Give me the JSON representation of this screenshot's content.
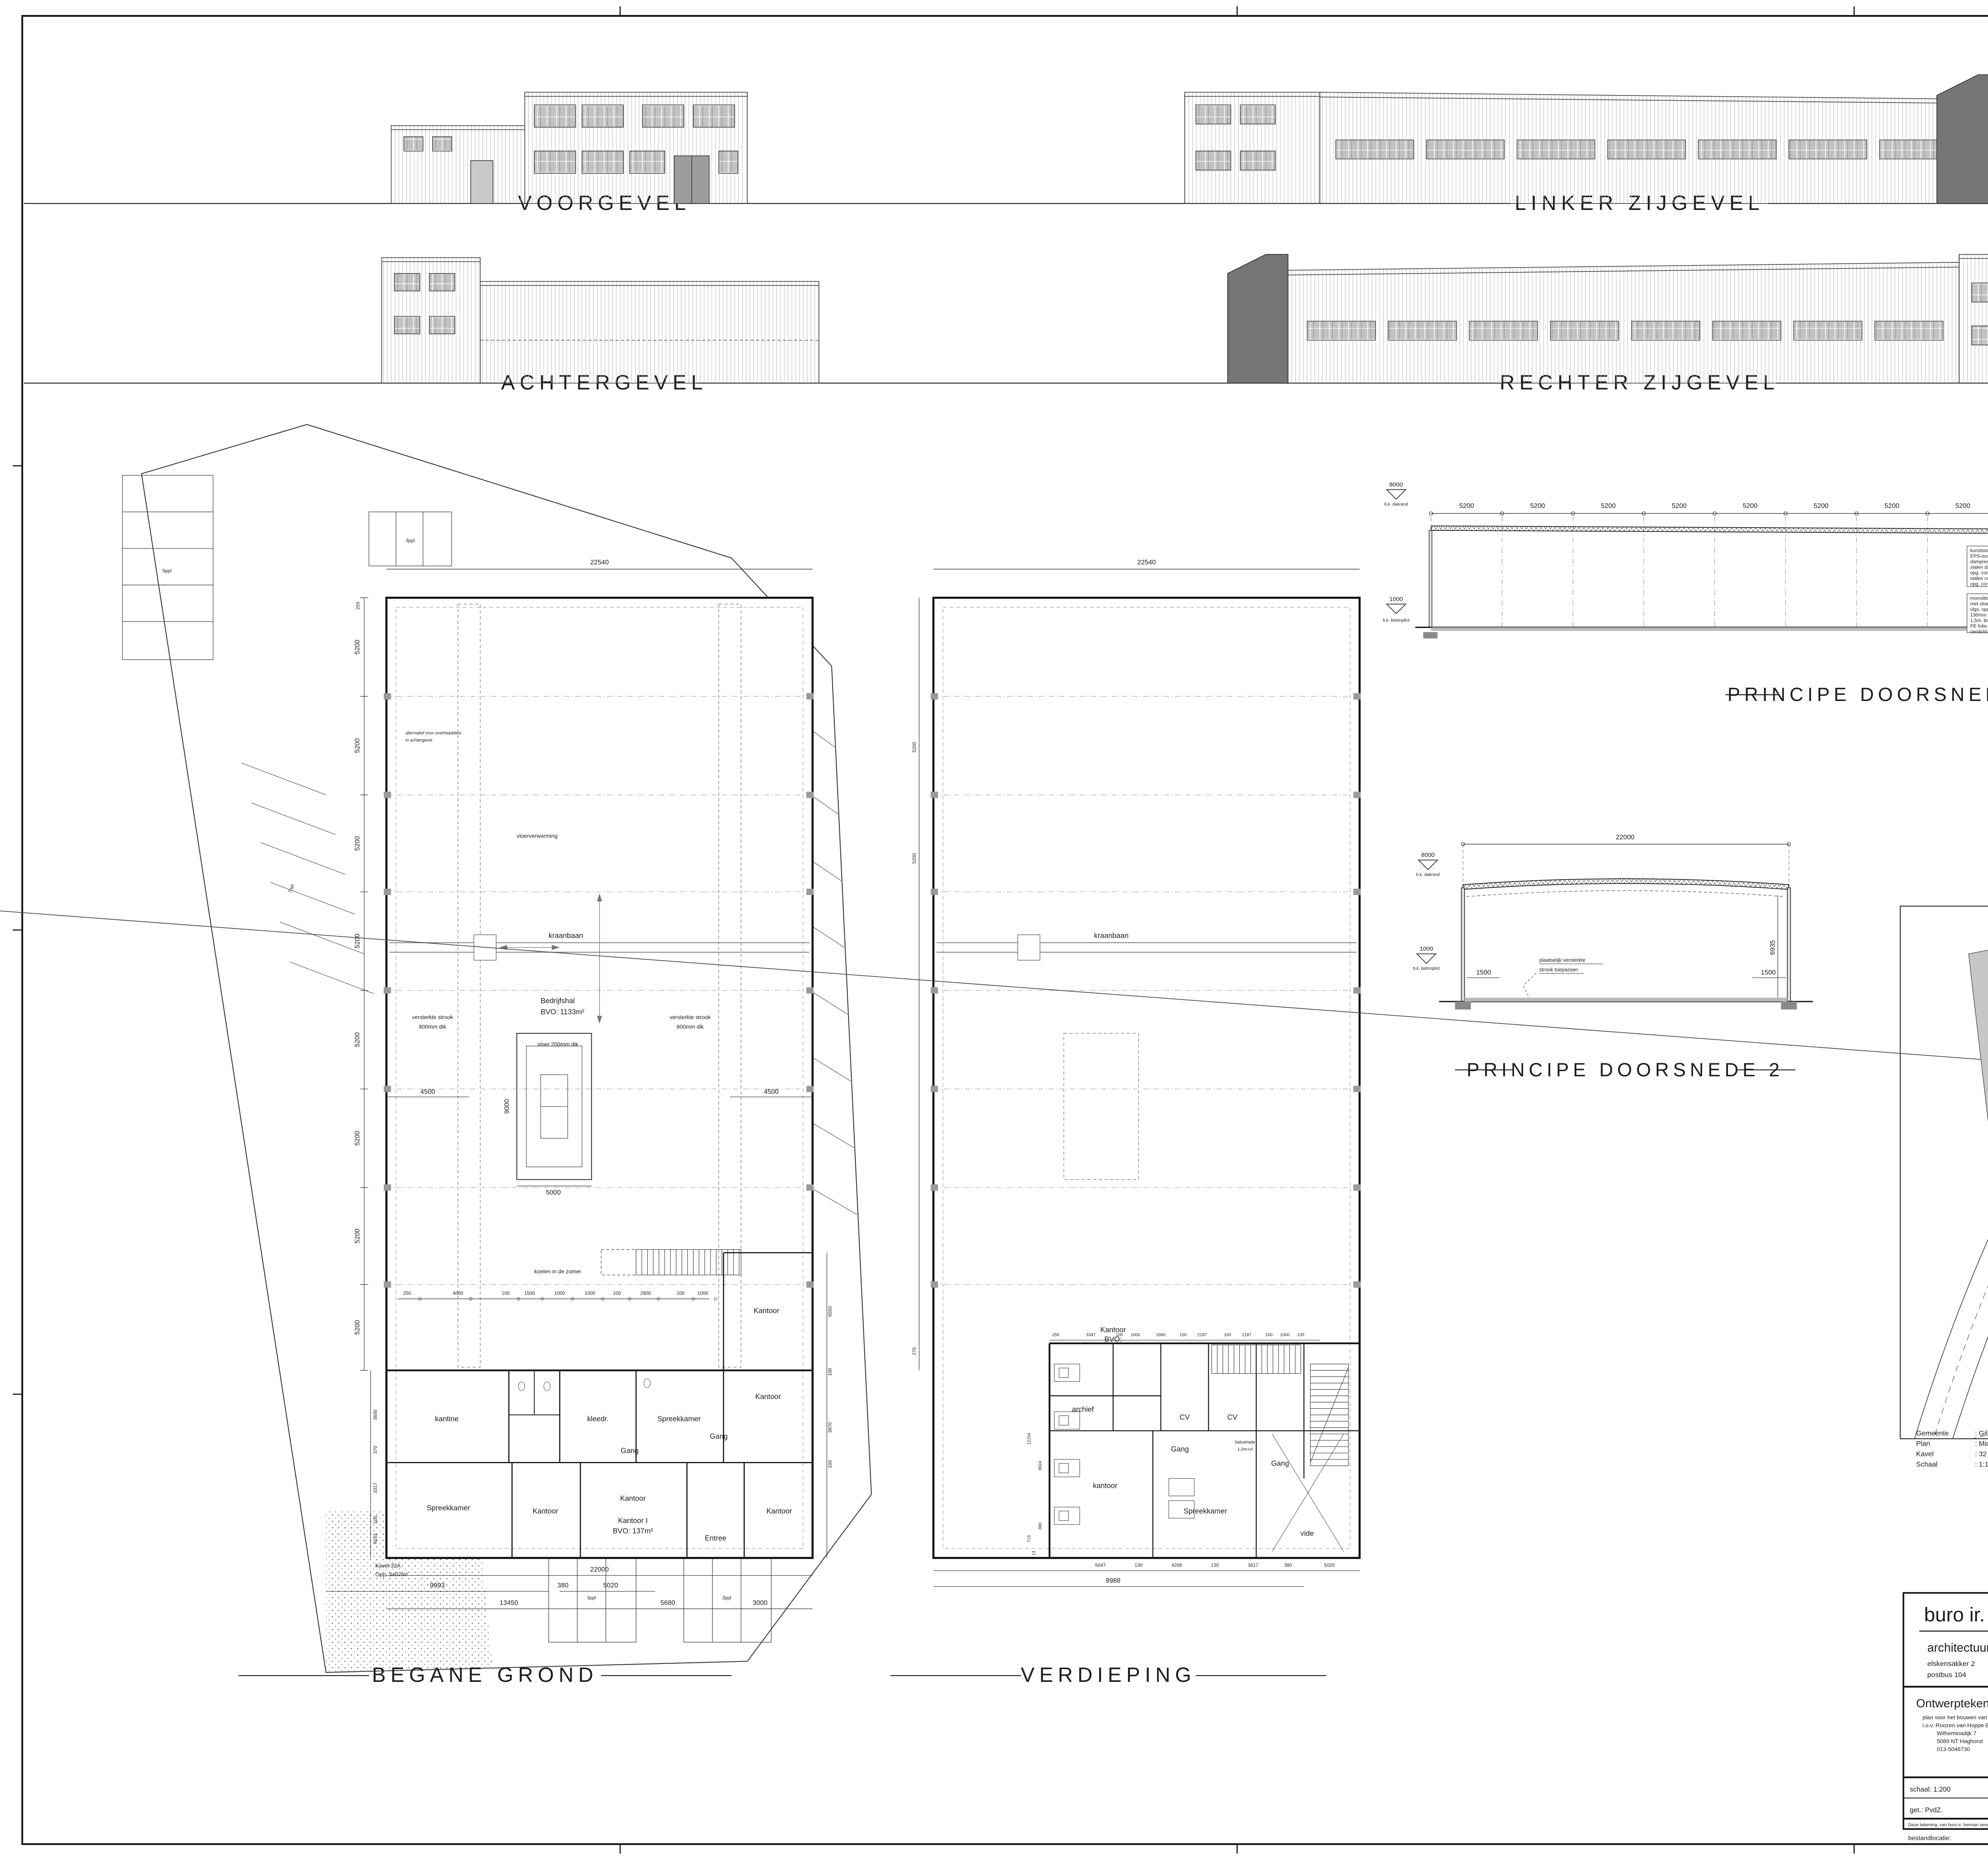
{
  "colors": {
    "accent_green": "#567d1f",
    "dark_volume": "#757575",
    "glazing": "#c2c2c2"
  },
  "sheet_labels": {
    "front": "VOORGEVEL",
    "left_side": "LINKER ZIJGEVEL",
    "rear": "ACHTERGEVEL",
    "right_side": "RECHTER ZIJGEVEL",
    "section1": "PRINCIPE DOORSNEDE 1",
    "section2": "PRINCIPE DOORSNEDE 2",
    "ground_floor": "BEGANE GROND",
    "first_floor": "VERDIEPING"
  },
  "project": {
    "gemeente_label": "Gemeente",
    "gemeente": ": Gilze-Rijen",
    "plan_label": "Plan",
    "plan": ": Midden Brabant Poort",
    "kavel_label": "Kavel",
    "kavel": ": 32",
    "schaal_label": "Schaal",
    "schaal": ": 1:1000"
  },
  "dims": {
    "d5200": "5200",
    "d22540": "22540",
    "d7720": "7720",
    "d380": "380",
    "d8000": "8000",
    "d3800": "3800",
    "d1000": "1000",
    "d1500": "1500",
    "d22000": "22000",
    "d6935": "6935",
    "d4500": "4500",
    "d9000": "9000",
    "d5000": "5000",
    "zero": "±0.00",
    "d270": "270"
  },
  "levels": {
    "dakrand": "b.k. dakrand",
    "vloer": "b.k. vloer",
    "betonplint": "b.k. betonplint"
  },
  "section1_specs": {
    "roof": [
      "kunststof dakbedekking",
      "EPS-isolatie Rc > 6.0",
      "dampremmende folie",
      "stalen dakplaat vlgs.",
      "opg. constructeur",
      "stalen constructie vlgs.",
      "opg. constructeur"
    ],
    "ground": [
      "monolitisch afgewerkte betonvloer",
      "met vloerverwarming",
      "vlgs. opg. constructeur",
      "130mm EPS-100 isolatie",
      "1,5m. breed langs zijkanten vloer",
      "PE folie",
      "verdicht zandpakket"
    ],
    "floor1": [
      "monolitische afwerkvloer 70mm",
      "met vloerverwarming",
      "kanaalplaatvloer",
      "vlgs. opg. constructeur",
      "stalenconstructie vlgs. opg. constr.",
      "systeemplafond"
    ],
    "ground2": [
      "monolitisch afgewerkte betonvloer",
      "met vloerverwarming",
      "vlgs. opg. constructeur",
      "isolatie Rc > 3,5",
      "PE folie",
      "verdicht zandpakket"
    ]
  },
  "section2": {
    "note1": "plaatselijk versterkte",
    "note2": "strook toepassen"
  },
  "ground_plan": {
    "annotations": {
      "koelen": "koelen in de zomer",
      "kraanbaan": "kraanbaan",
      "vloerverwarming": "vloerverwarming",
      "bedrijfshal": "Bedrijfshal",
      "bvo": "BVO: 1133m²",
      "vloer": "vloer 200mm dik",
      "strook1": "versterkte strook",
      "strook2": "800mm dik",
      "alt1": "alternatief voor overheaddeur",
      "alt2": "in achtergevel",
      "kavel1": "Kavel 32A",
      "kavel2": "Opp: 3407m²"
    },
    "rooms": {
      "kantine": "kantine",
      "kleedr": "kleedr.",
      "spreekkamer": "Spreekkamer",
      "gang": "Gang",
      "kantoor": "Kantoor",
      "kantoor1": "Kantoor I",
      "kantoor1_bvo": "BVO: 137m²",
      "entree": "Entree"
    },
    "dimrow": [
      "250",
      "4000",
      "100",
      "1500",
      "1000",
      "1000",
      "100",
      "2900",
      "100",
      "1000"
    ],
    "left_chain": [
      "3600",
      "370",
      "3317",
      "100",
      "4033"
    ],
    "right_chain": [
      "6550",
      "100",
      "3870",
      "100"
    ],
    "bottom": [
      "22000",
      "9993",
      "380",
      "5020",
      "13450",
      "5680",
      "3000"
    ]
  },
  "first_floor_plan": {
    "rooms": {
      "archief": "archief",
      "cv": "CV",
      "gang": "Gang",
      "balustrade1": "balustrade",
      "balustrade2": "1,0m+vl",
      "kantoor": "kantoor",
      "kantoor_bvo1": "Kantoor",
      "kantoor_bvo2": "BVO:",
      "spreekkamer": "Spreekkamer",
      "vide": "vide"
    },
    "dimrow": [
      "250",
      "3347",
      "100",
      "1000",
      "1680",
      "100",
      "2187",
      "100",
      "2187",
      "100",
      "1000",
      "135"
    ],
    "left_chain": [
      "12154",
      "9924",
      "713",
      "380",
      "13"
    ],
    "side_chain": [
      "5200",
      "5200",
      "270"
    ],
    "bottom": [
      "5047",
      "130",
      "4206",
      "130",
      "3617",
      "380",
      "5020",
      "9988"
    ]
  },
  "parking": {
    "p3": "3ppl",
    "p5": "5ppl",
    "p7": "7ppl"
  },
  "site": {
    "north": "N"
  },
  "title_block": {
    "firm": "buro ir. herman sengers",
    "tagline_black": "architectuur | design |",
    "tagline_green": "realisatie",
    "address1": "elskensakker 2",
    "address1b": "5571 sk bergeijk",
    "address2": "postbus 104",
    "address2b": "5570 ac bergeijk",
    "tel": "tel: 0497 573204   fax: 0497-574300",
    "email": "e-mail: info@burosengers.nl",
    "doc_type": "Ontwerptekening",
    "desc1": "plan voor het bouwen van een bedrijfshal   te Gilze tbv. MK Gilze",
    "desc2": "i.o.v. Roozen van Hoppe Bauw & Ontwikkeling",
    "desc3": "Wilheminadijk 7",
    "desc4": "5089 NT Haghorst",
    "desc5": "013-5046730",
    "werknr_label": "werknr.",
    "werknr": "16-2293",
    "bladnr_label": "bladnr.",
    "bladnr": "010.",
    "schaal": "schaal: 1:200",
    "dd": "d.d.:   30.09.2016",
    "gewB": "gew.B:  24-09-2018",
    "gewD": "gew.D:  26.10.2018",
    "gewF": "gew.F:",
    "get": "get.:   PvdZ.",
    "gewA": "gew.A:  03.10.2016",
    "gewC": "gew.C:  27-09-2018",
    "gewE": "gew.E:  30.11.2018",
    "ig": "i.g.    :",
    "formaat": "formaat:  A1",
    "disclaimer": "Deze tekening, van buro ir. herman sengers, mag alleen met onze toestemming geheel of gedeeltelijk gebruikt, gekopieerd of aan derden verstrekt worden. ©",
    "file_label": "bestandlocatie:"
  }
}
